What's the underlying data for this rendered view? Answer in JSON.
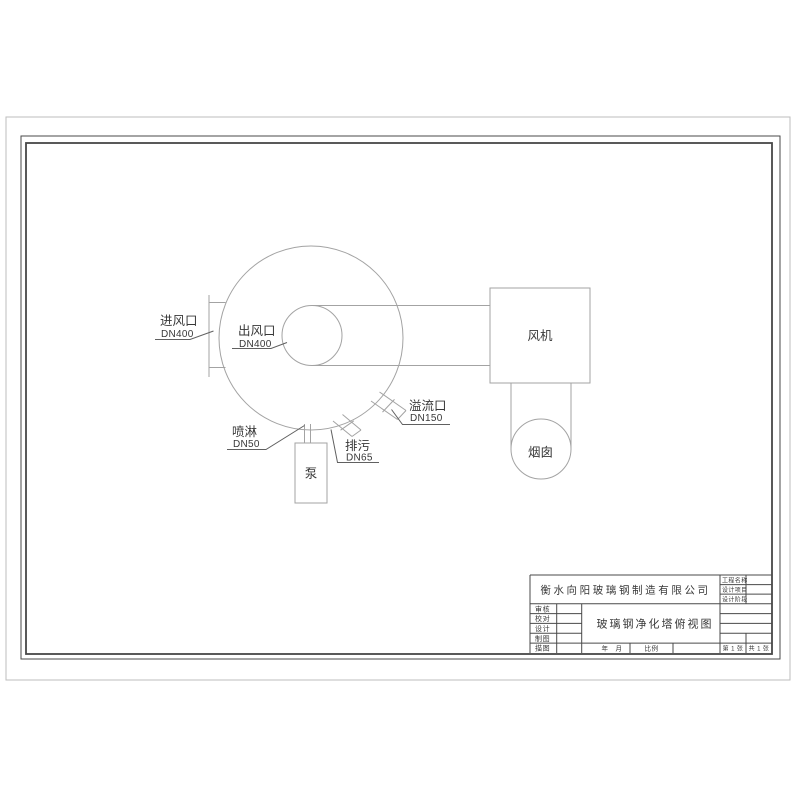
{
  "colors": {
    "geometry_line": "#a3a3a3",
    "leader_line": "#606060",
    "frame_line": "#4f4f4f",
    "text": "#383838",
    "paper": "#ffffff"
  },
  "drawing_labels": {
    "inlet_name": "进风口",
    "inlet_size": "DN400",
    "outlet_name": "出风口",
    "outlet_size": "DN400",
    "spray_name": "喷淋",
    "spray_size": "DN50",
    "drain_name": "排污",
    "drain_size": "DN65",
    "overflow_name": "溢流口",
    "overflow_size": "DN150",
    "fan": "风机",
    "chimney": "烟囱",
    "pump": "泵"
  },
  "title_block": {
    "company": "衡水向阳玻璃钢制造有限公司",
    "drawing_title": "玻璃钢净化塔俯视图",
    "project_fields": [
      "工程名称",
      "设计项目",
      "设计阶段"
    ],
    "role_fields": [
      "审核",
      "校对",
      "设计",
      "制图",
      "描图"
    ],
    "date_label": "年　月",
    "scale_label": "比例",
    "sheet_no": "第 1 张",
    "sheet_total": "共 1 张"
  }
}
